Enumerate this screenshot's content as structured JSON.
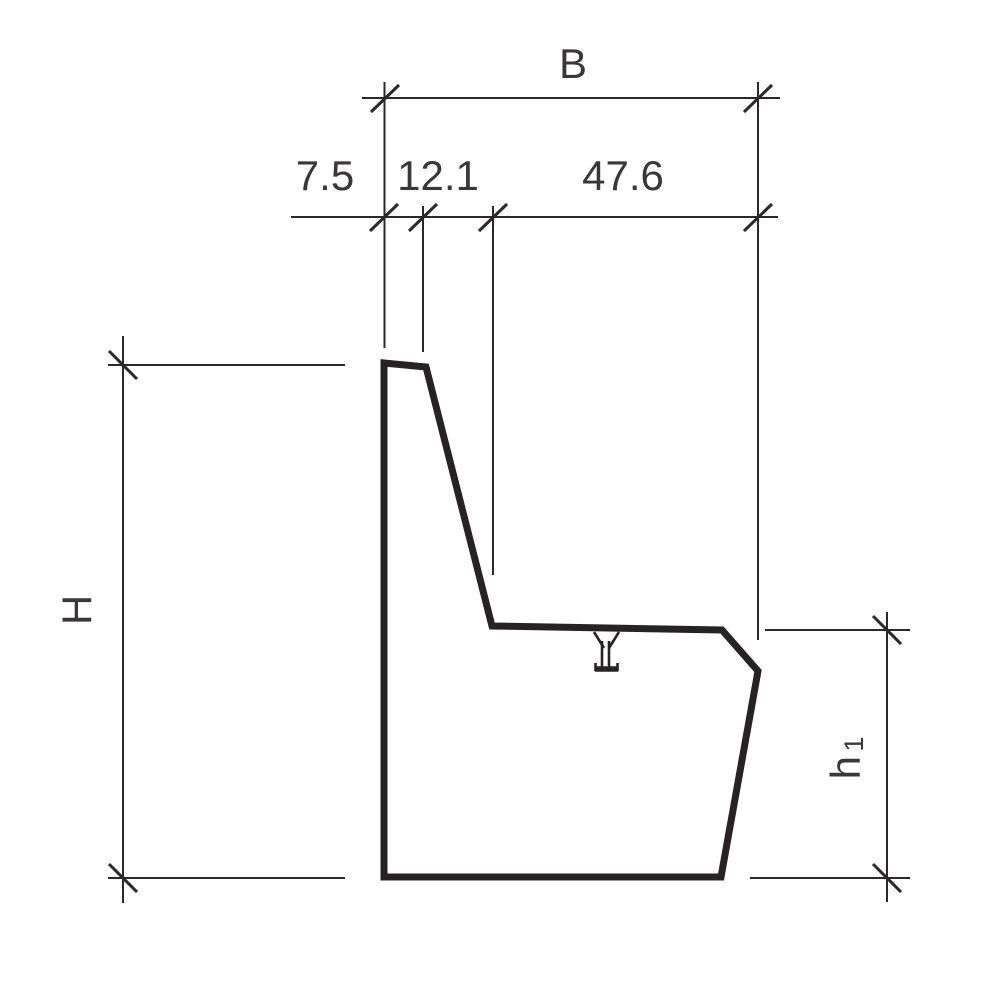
{
  "drawing": {
    "kind": "technical-cross-section",
    "background_color": "#ffffff",
    "line_color": "#2b2829",
    "profile_color": "#262324",
    "text_color": "#3a3738",
    "dimensions": {
      "total_width": {
        "label": "B"
      },
      "segments": [
        {
          "value": "7.5"
        },
        {
          "value": "12.1"
        },
        {
          "value": "47.6"
        }
      ],
      "total_height": {
        "label": "H"
      },
      "seat_height": {
        "label": "h",
        "subscript": "1"
      }
    }
  }
}
